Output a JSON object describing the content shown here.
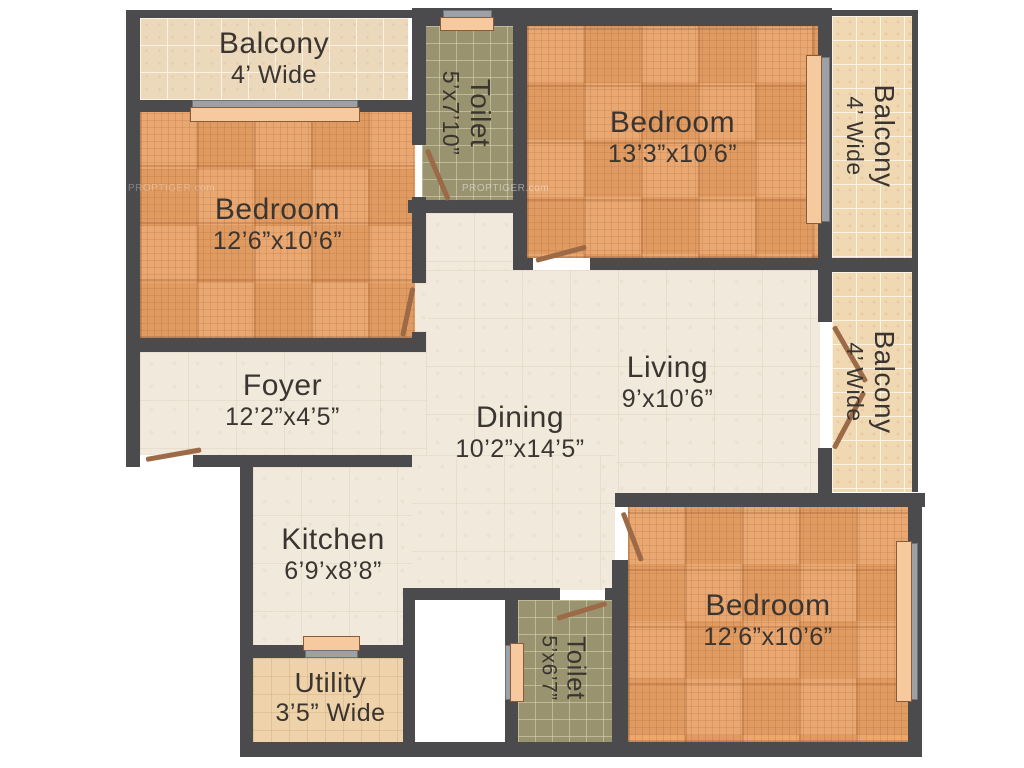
{
  "plan_title": "Residential floor plan",
  "watermark": "PROPTIGER.com",
  "rooms": {
    "balcony_top_left": {
      "name": "Balcony",
      "dims": "4’ Wide"
    },
    "bedroom_top_left": {
      "name": "Bedroom",
      "dims": "12’6”x10’6”"
    },
    "toilet_top": {
      "name": "Toilet",
      "dims": "5’x7’10”"
    },
    "bedroom_top_right": {
      "name": "Bedroom",
      "dims": "13’3”x10’6”"
    },
    "balcony_top_right": {
      "name": "Balcony",
      "dims": "4’ Wide"
    },
    "balcony_mid_right": {
      "name": "Balcony",
      "dims": "4’ Wide"
    },
    "foyer": {
      "name": "Foyer",
      "dims": "12’2”x4’5”"
    },
    "living": {
      "name": "Living",
      "dims": "9’x10’6”"
    },
    "dining": {
      "name": "Dining",
      "dims": "10’2”x14’5”"
    },
    "kitchen": {
      "name": "Kitchen",
      "dims": "6’9’x8’8”"
    },
    "utility": {
      "name": "Utility",
      "dims": "3’5” Wide"
    },
    "toilet_bottom": {
      "name": "Toilet",
      "dims": "5’x6’7”"
    },
    "bedroom_bottom_right": {
      "name": "Bedroom",
      "dims": "12’6”x10’6”"
    }
  },
  "colors": {
    "wall": "#4b4b4e",
    "parquet_floor": "#e9a772",
    "balcony_tile": "#ecd9bb",
    "balcony_tile_warm": "#f0d8b2",
    "toilet_tile": "#9a9370",
    "cream_floor": "#f1e9db",
    "utility_tile": "#eed2aa",
    "window_sill": "#f6c99e",
    "door_leaf": "#9c6a46",
    "text": "#3a3530"
  }
}
